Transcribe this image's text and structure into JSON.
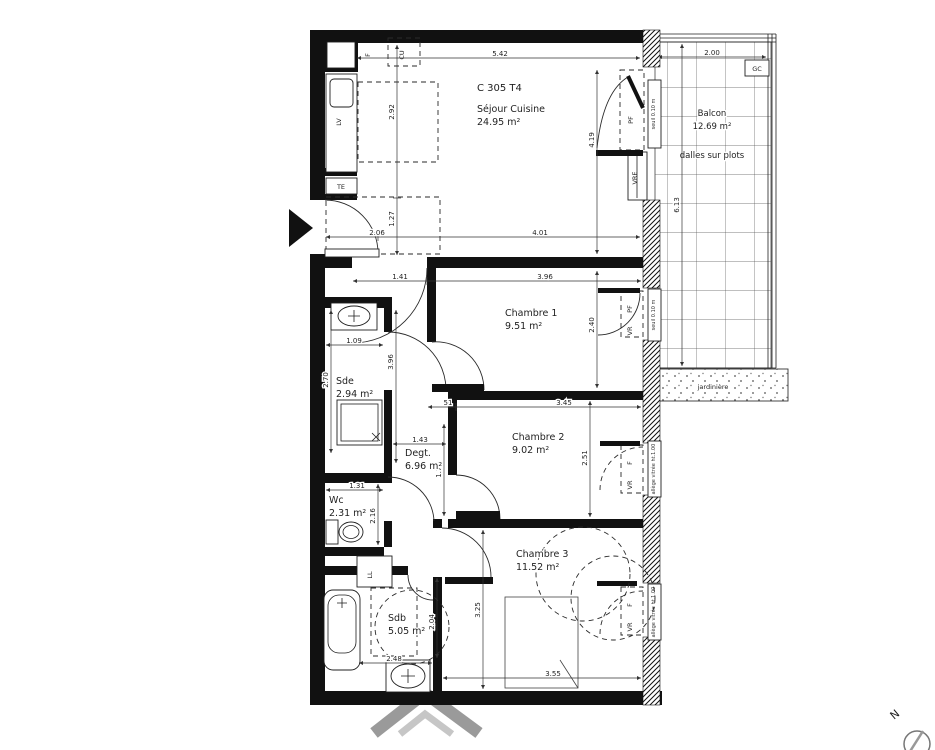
{
  "title": "C 305 T4",
  "rooms": {
    "sejour": {
      "name": "Séjour Cuisine",
      "area": "24.95 m²"
    },
    "chambre1": {
      "name": "Chambre 1",
      "area": "9.51 m²"
    },
    "chambre2": {
      "name": "Chambre 2",
      "area": "9.02 m²"
    },
    "chambre3": {
      "name": "Chambre 3",
      "area": "11.52 m²"
    },
    "sde": {
      "name": "Sde",
      "area": "2.94 m²"
    },
    "degt": {
      "name": "Degt.",
      "area": "6.96 m²"
    },
    "wc": {
      "name": "Wc",
      "area": "2.31 m²"
    },
    "sdb": {
      "name": "Sdb",
      "area": "5.05 m²"
    },
    "balcon": {
      "name": "Balcon",
      "area": "12.69 m²",
      "note": "dalles sur plots"
    }
  },
  "labels": {
    "jardiniere": "jardinière",
    "north": "N",
    "f": "F",
    "cu": "CU",
    "lv": "LV",
    "te": "TE",
    "ll": "LL",
    "gc": "GC",
    "pf": "PF",
    "vre": "VRE",
    "vr": "VR",
    "fwin": "F",
    "seuil": "seuil 0.10 m",
    "allege": "allège vitrée ht.1.00"
  },
  "dims": {
    "top": "5.42",
    "balcony_w": "2.00",
    "kitchen_h": "2.92",
    "sejour_h": "4.19",
    "balcony_h": "6.13",
    "entry_h": "1.27",
    "entry_w": "2.06",
    "sejour_w": "4.01",
    "hall_w": "1.41",
    "ch1_w": "3.96",
    "ch1_h": "2.40",
    "sde_w": "1.09",
    "sde_h": "2.70",
    "corridor_h": "3.96",
    "ch2_off": "51",
    "ch2_w": "3.45",
    "degt_w": "1.43",
    "degt_h": "1.78",
    "ch2_h": "2.51",
    "wc_w": "1.31",
    "wc_h": "2.16",
    "ch3_h": "3.25",
    "sdb_h": "2.04",
    "sdb_w": "2.48",
    "ch3_w": "3.55"
  }
}
